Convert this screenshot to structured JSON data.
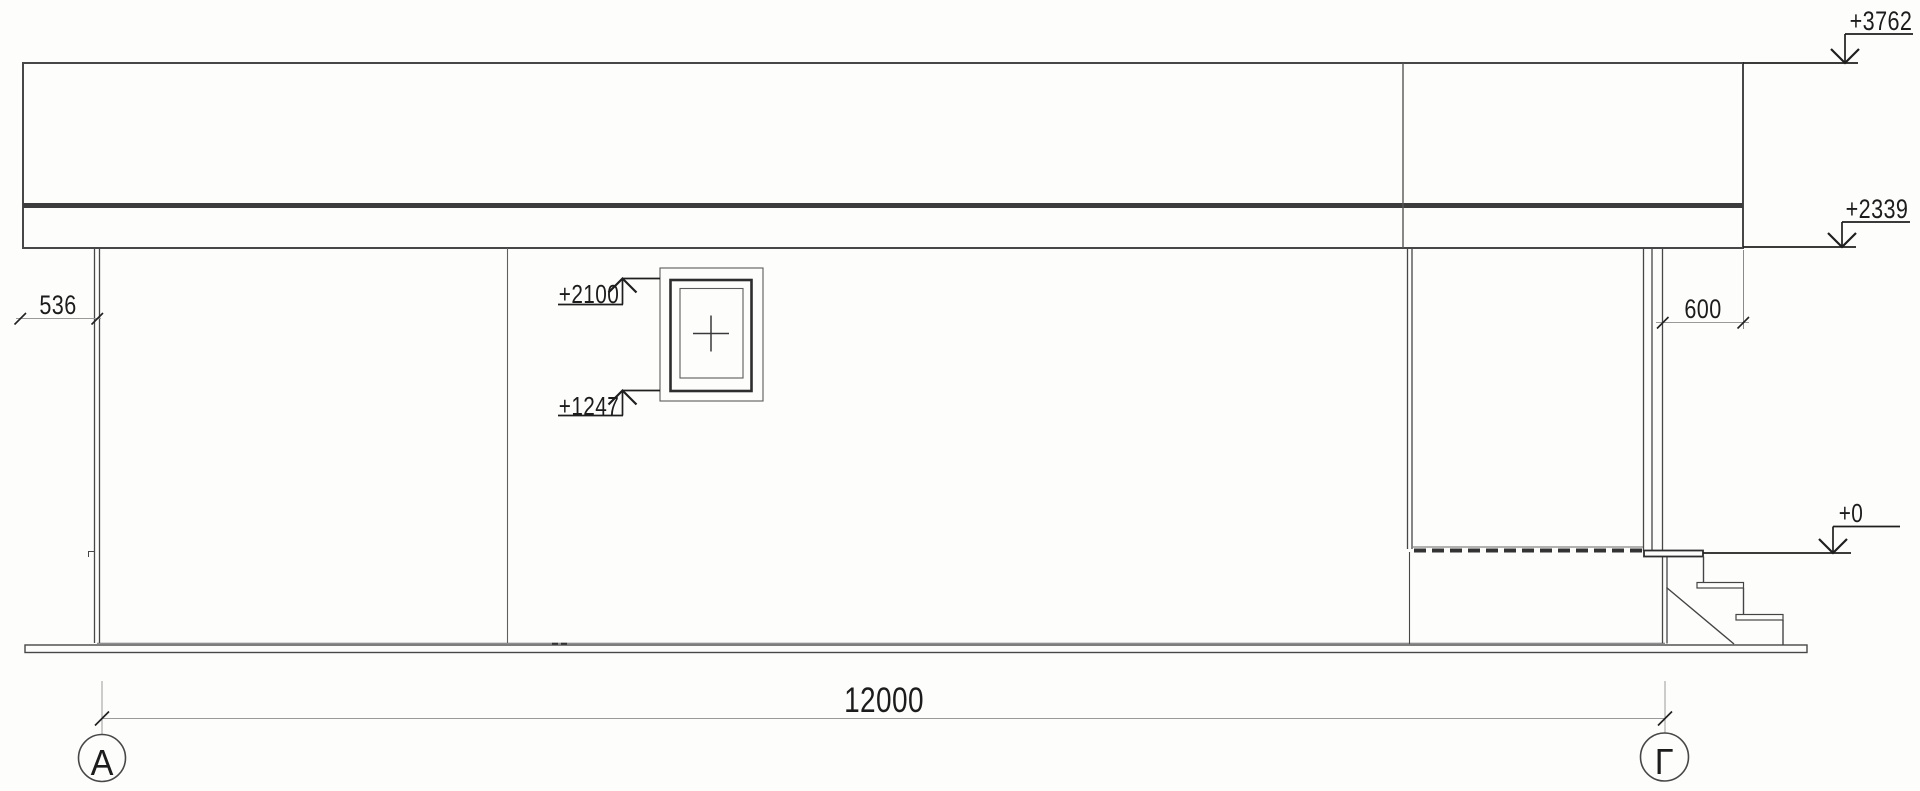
{
  "drawing_type": "architectural facade elevation",
  "levels": {
    "roof_top": "+3762",
    "eaves": "+2339",
    "window_head": "+2100",
    "window_sill": "+1247",
    "floor": "+0"
  },
  "dims": {
    "span": "12000",
    "left_overhang": "536",
    "right_overhang": "600"
  },
  "axes": {
    "left": "А",
    "right": "Г"
  }
}
